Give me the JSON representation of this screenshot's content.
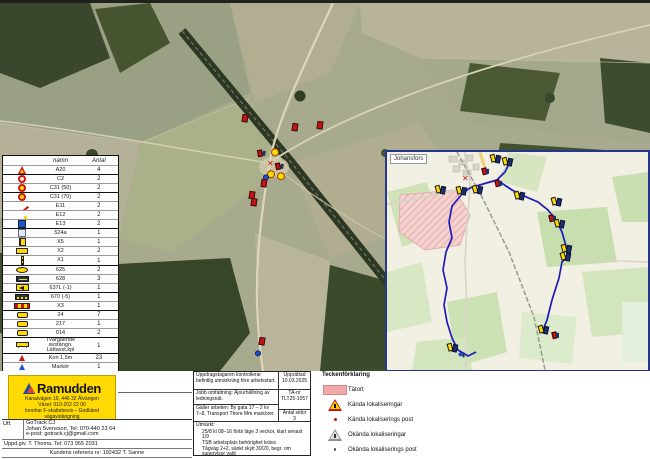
{
  "colors": {
    "ramudden_yellow": "#ffd900",
    "brand_blue": "#1d4f91",
    "brand_red": "#e8442d",
    "route_blue": "#1c1cb8",
    "urban_pink": "#f3d2d0",
    "cone_red": "#d01414",
    "sign_blue": "#1d55c8"
  },
  "legend_table": {
    "headers": [
      "",
      "namn",
      "Antal"
    ],
    "rows": [
      {
        "icon": "li-tri",
        "name": "A20",
        "count": "4",
        "group": false
      },
      {
        "icon": "li-circ",
        "name": "C2",
        "count": "2",
        "group": true
      },
      {
        "icon": "li-circ-yel",
        "name": "C31 (50)",
        "count": "2",
        "group": false
      },
      {
        "icon": "li-circ-yel",
        "name": "C31 (70)",
        "count": "2",
        "group": true
      },
      {
        "icon": "li-blue-red",
        "name": "E11",
        "count": "2",
        "group": false
      },
      {
        "icon": "li-blue-mark",
        "name": "E12",
        "count": "2",
        "group": false
      },
      {
        "icon": "li-blue",
        "name": "E13",
        "count": "2",
        "group": false
      },
      {
        "icon": "li-pale",
        "name": "524a",
        "count": "1",
        "group": true
      },
      {
        "icon": "li-x5",
        "name": "X5",
        "count": "1",
        "group": false
      },
      {
        "icon": "li-x2",
        "name": "X2",
        "count": "2",
        "group": false
      },
      {
        "icon": "li-x1bar",
        "name": "X1",
        "count": "1",
        "group": false
      },
      {
        "icon": "li-oval",
        "name": "625",
        "count": "2",
        "group": true
      },
      {
        "icon": "li-628",
        "name": "628",
        "count": "3",
        "group": false
      },
      {
        "icon": "li-arrow",
        "name": "637L (-1)",
        "count": "1",
        "group": false
      },
      {
        "icon": "li-zig",
        "name": "670 (-5)",
        "count": "1",
        "group": true
      },
      {
        "icon": "li-x3",
        "name": "X3",
        "count": "1",
        "group": false
      },
      {
        "icon": "li-ysmall",
        "name": "24",
        "count": "7",
        "group": true
      },
      {
        "icon": "li-ysmall",
        "name": "217",
        "count": "1",
        "group": false
      },
      {
        "icon": "li-ysmall",
        "name": "014",
        "count": "2",
        "group": false
      },
      {
        "icon": "li-trestle",
        "name": "Tvärgående avstängn. Lättavst.kpl",
        "count": "1",
        "group": true
      },
      {
        "icon": "li-cone",
        "name": "Kon 1,5m",
        "count": "23",
        "group": true
      },
      {
        "icon": "li-markerblue",
        "name": "Markör",
        "count": "1",
        "group": false
      },
      {
        "icon": "li-person",
        "name": "Personal",
        "count": "1",
        "group": false
      }
    ]
  },
  "main_map": {
    "markers": [
      {
        "type": "sign-red",
        "x": 245,
        "y": 119
      },
      {
        "type": "sign-red",
        "x": 295,
        "y": 128
      },
      {
        "type": "sign-red",
        "x": 320,
        "y": 126
      },
      {
        "type": "sign-red-pair",
        "x": 262,
        "y": 154
      },
      {
        "type": "sign-yellow",
        "x": 275,
        "y": 153
      },
      {
        "type": "cross-red",
        "x": 271,
        "y": 165
      },
      {
        "type": "sign-red-pair",
        "x": 280,
        "y": 167
      },
      {
        "type": "sign-yellow",
        "x": 271,
        "y": 175
      },
      {
        "type": "sign-yellow",
        "x": 281,
        "y": 177
      },
      {
        "type": "sign-blue",
        "x": 266,
        "y": 178
      },
      {
        "type": "sign-red",
        "x": 264,
        "y": 184
      },
      {
        "type": "sign-red",
        "x": 252,
        "y": 196
      },
      {
        "type": "sign-red",
        "x": 254,
        "y": 203
      },
      {
        "type": "sign-red",
        "x": 262,
        "y": 342
      },
      {
        "type": "sign-blue",
        "x": 258,
        "y": 354
      }
    ]
  },
  "inset_map": {
    "label": "Johansfors",
    "markers": [
      {
        "type": "flag-pair",
        "x": 495,
        "y": 159
      },
      {
        "type": "flag-pair",
        "x": 507,
        "y": 162
      },
      {
        "type": "flag-red",
        "x": 486,
        "y": 172
      },
      {
        "type": "cross-red",
        "x": 466,
        "y": 180
      },
      {
        "type": "flag-pair",
        "x": 440,
        "y": 190
      },
      {
        "type": "flag-pair",
        "x": 461,
        "y": 191
      },
      {
        "type": "flag-pair",
        "x": 477,
        "y": 190
      },
      {
        "type": "flag-red",
        "x": 499,
        "y": 184
      },
      {
        "type": "flag-pair",
        "x": 519,
        "y": 196
      },
      {
        "type": "flag-pair",
        "x": 556,
        "y": 202
      },
      {
        "type": "flag-red",
        "x": 553,
        "y": 219
      },
      {
        "type": "flag-pair",
        "x": 559,
        "y": 224
      },
      {
        "type": "flag-pair",
        "x": 566,
        "y": 249
      },
      {
        "type": "flag-pair",
        "x": 565,
        "y": 257
      },
      {
        "type": "flag-pair",
        "x": 543,
        "y": 330
      },
      {
        "type": "flag-red",
        "x": 556,
        "y": 336
      },
      {
        "type": "flag-pair",
        "x": 452,
        "y": 348
      },
      {
        "type": "flag-blue",
        "x": 462,
        "y": 356
      }
    ]
  },
  "ramudden": {
    "brand": "Ramudden",
    "addr1": "Kanalvägen 10, 446 32 Älvängen",
    "addr2": "Växel: 010-202 22 00",
    "addr3": "Innehar F-skattebevis – Godkänd vägavstängning"
  },
  "contractor": {
    "utf_label": "Utf.",
    "company": "GoTrack CJ",
    "contact": "Johan Svensson, Tel: 070-440 23 64",
    "email": "e-post: gotrack.cj@gmail.com",
    "uppdrag": "Uppd.giv.  T. Thoma, Tel: 073 955 2031",
    "ref": "Kundens referens nr: 192432 T. Sanne",
    "plan_nr": "Trafikanordningsplan nr ELK00003"
  },
  "plan_info": {
    "row1": "Uppdragstagaren kontrollerar befintlig utmärkning före arbetsstart.",
    "row2": "Jobb omfattning: Ajourhållning av ledningsnät.",
    "row3": "Gäller arbeten: By gata 17 – 2 kv 7–8, Transport Thore Mm markörer.",
    "notes_label": "Utmärkt:",
    "notes": [
      "25/8 kl 08–16 förbi läge 3 veckor, klart senast 1/9",
      "TSB arbetsplats behörighet krävs",
      "Tågväg 2+2, sänkt skylt 30/20, begr. om supervisor vald"
    ],
    "meta": {
      "upprattad_label": "Upprättad",
      "upprattad": "10.03.2025",
      "ta_nr_label": "TA-nr",
      "ta_nr": "TLT25-1057",
      "sidor_label": "Antal sidor",
      "sidor": "3"
    }
  },
  "symbol_legend": {
    "title": "Teckenförklaring",
    "items": [
      {
        "label": "Tätort"
      },
      {
        "label": "Kända lokaliseringar"
      },
      {
        "label": "Kända lokaliserings post"
      },
      {
        "label": "Okända lokaliseringar"
      },
      {
        "label": "Okända lokaliserings post"
      }
    ]
  }
}
